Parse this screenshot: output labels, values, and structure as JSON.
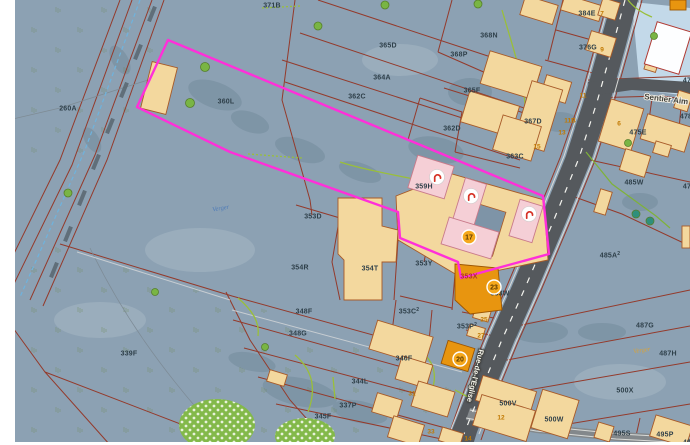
{
  "map": {
    "colors": {
      "background": "#8ca1b3",
      "parcel_line": "#943a2b",
      "selection_magenta": "#ff2fd9",
      "building_tan": "#f3d89e",
      "building_orange": "#e8950f",
      "building_pink": "#f5cfd6",
      "road_gray": "#55595d",
      "badge_fill": "#f5a81c",
      "icon_glyph_red": "#d63226",
      "orchard_green": "#83b94a"
    },
    "street_labels": [
      {
        "text": "Sentier Aim",
        "x": 644,
        "y": 99,
        "rot": 7,
        "style": "path"
      },
      {
        "text": "Rue-de-l'Eglise",
        "x": 479,
        "y": 349,
        "rot": 103,
        "style": "road"
      }
    ],
    "area_labels": [
      {
        "text": "Verger",
        "x": 221,
        "y": 210,
        "rot": -10,
        "color": "blue"
      },
      {
        "text": "Verger",
        "x": 642,
        "y": 352,
        "rot": -8,
        "color": "orange"
      }
    ],
    "parcel_labels": [
      {
        "text": "371B",
        "x": 272,
        "y": 5
      },
      {
        "text": "365D",
        "x": 388,
        "y": 45
      },
      {
        "text": "368N",
        "x": 489,
        "y": 35
      },
      {
        "text": "368P",
        "x": 459,
        "y": 54
      },
      {
        "text": "364A",
        "x": 382,
        "y": 77
      },
      {
        "text": "362C",
        "x": 357,
        "y": 96
      },
      {
        "text": "360L",
        "x": 226,
        "y": 101
      },
      {
        "text": "260A",
        "x": 68,
        "y": 108
      },
      {
        "text": "365F",
        "x": 472,
        "y": 90
      },
      {
        "text": "362D",
        "x": 452,
        "y": 128
      },
      {
        "text": "367D",
        "x": 533,
        "y": 121
      },
      {
        "text": "363C",
        "x": 515,
        "y": 156
      },
      {
        "text": "376G",
        "x": 588,
        "y": 47
      },
      {
        "text": "384E",
        "x": 587,
        "y": 13
      },
      {
        "text": "475E",
        "x": 638,
        "y": 132
      },
      {
        "text": "478",
        "x": 686,
        "y": 116
      },
      {
        "text": "475",
        "x": 689,
        "y": 80
      },
      {
        "text": "476",
        "x": 689,
        "y": 186
      },
      {
        "text": "485W",
        "x": 634,
        "y": 182
      },
      {
        "text": "359H",
        "x": 424,
        "y": 186
      },
      {
        "text": "353D",
        "x": 313,
        "y": 216
      },
      {
        "text": "354R",
        "x": 300,
        "y": 267
      },
      {
        "text": "354T",
        "x": 370,
        "y": 268
      },
      {
        "text": "353Y",
        "x": 424,
        "y": 263
      },
      {
        "text": "353W",
        "x": 500,
        "y": 293
      },
      {
        "text": "487G",
        "x": 645,
        "y": 325
      },
      {
        "text": "487H",
        "x": 668,
        "y": 353
      },
      {
        "text": "500X",
        "x": 625,
        "y": 390
      },
      {
        "text": "500V",
        "x": 508,
        "y": 403
      },
      {
        "text": "500W",
        "x": 554,
        "y": 419
      },
      {
        "text": "495S",
        "x": 622,
        "y": 433
      },
      {
        "text": "495P",
        "x": 665,
        "y": 434
      },
      {
        "text": "495",
        "x": 689,
        "y": 442
      },
      {
        "text": "348F",
        "x": 304,
        "y": 311
      },
      {
        "text": "348G",
        "x": 298,
        "y": 333
      },
      {
        "text": "346F",
        "x": 404,
        "y": 358
      },
      {
        "text": "344L",
        "x": 360,
        "y": 381
      },
      {
        "text": "337P",
        "x": 348,
        "y": 405
      },
      {
        "text": "345F",
        "x": 323,
        "y": 416
      },
      {
        "text": "339F",
        "x": 129,
        "y": 353
      }
    ],
    "highlight_parcel_labels": [
      {
        "text": "353X",
        "x": 469,
        "y": 276
      }
    ],
    "superscript_parcel_labels": [
      {
        "text": "485A",
        "sup": "2",
        "x": 610,
        "y": 255
      },
      {
        "text": "353C",
        "sup": "2",
        "x": 409,
        "y": 311
      },
      {
        "text": "353P",
        "sup": "2",
        "x": 467,
        "y": 326
      }
    ],
    "building_numbers": [
      {
        "text": "7",
        "x": 602,
        "y": 13
      },
      {
        "text": "9",
        "x": 602,
        "y": 49
      },
      {
        "text": "11",
        "x": 583,
        "y": 95
      },
      {
        "text": "11B",
        "x": 570,
        "y": 120
      },
      {
        "text": "13",
        "x": 562,
        "y": 132
      },
      {
        "text": "15",
        "x": 537,
        "y": 146
      },
      {
        "text": "6",
        "x": 619,
        "y": 123
      },
      {
        "text": "25",
        "x": 484,
        "y": 319
      },
      {
        "text": "27",
        "x": 481,
        "y": 335
      },
      {
        "text": "31",
        "x": 412,
        "y": 393
      },
      {
        "text": "33",
        "x": 431,
        "y": 431
      },
      {
        "text": "12",
        "x": 501,
        "y": 417
      },
      {
        "text": "14",
        "x": 468,
        "y": 438
      },
      {
        "text": "1",
        "x": 477,
        "y": 444
      }
    ],
    "poi_badges": [
      {
        "number": "17",
        "x": 469,
        "y": 237
      },
      {
        "number": "20",
        "x": 460,
        "y": 359
      },
      {
        "number": "23",
        "x": 494,
        "y": 287
      }
    ],
    "monument_icons": [
      {
        "x": 437,
        "y": 177
      },
      {
        "x": 471,
        "y": 196
      },
      {
        "x": 529,
        "y": 214
      }
    ]
  }
}
